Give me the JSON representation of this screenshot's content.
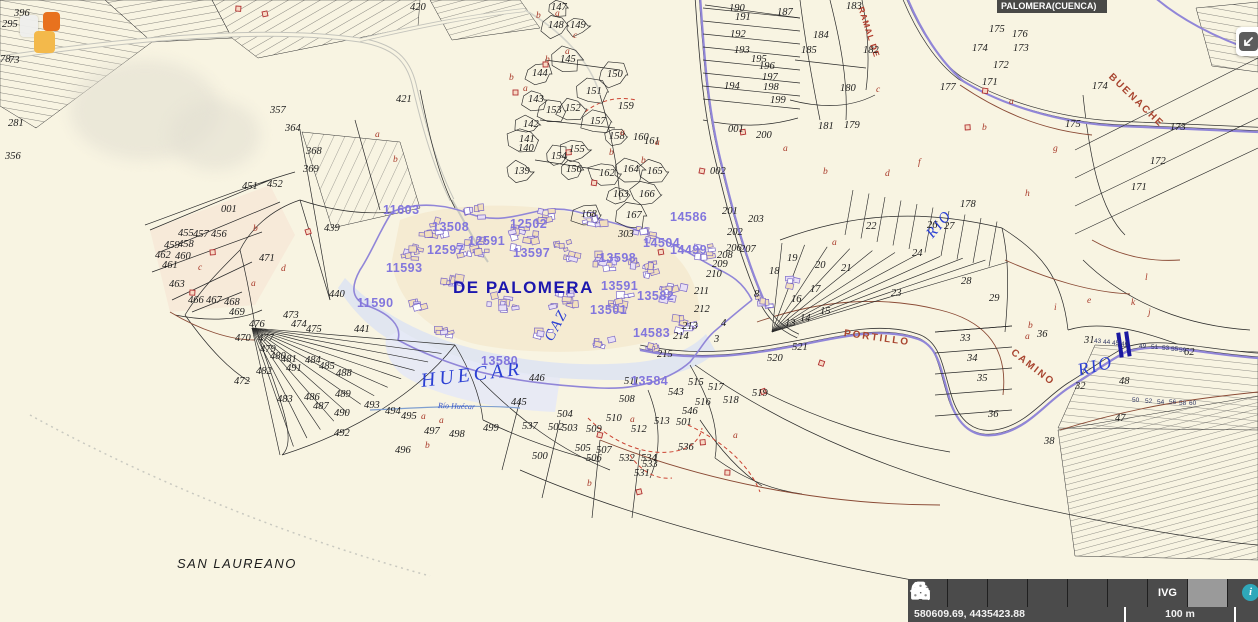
{
  "title_bar": {
    "text": "PALOMERA(CUENCA)"
  },
  "status_bar": {
    "coordinates": "580609.69, 4435423.88",
    "scale_label": "100 m"
  },
  "toolbar": {
    "buttons": [
      {
        "name": "expand-panel",
        "icon": "chevron-right-icon"
      },
      {
        "name": "zoom-search",
        "icon": "magnifier-icon"
      },
      {
        "name": "layers",
        "icon": "layers-icon"
      },
      {
        "name": "measure",
        "icon": "arrows-horizontal-icon"
      },
      {
        "name": "print",
        "icon": "printer-icon"
      },
      {
        "name": "point-query",
        "icon": "pointer-p-icon",
        "glyph": "P"
      },
      {
        "name": "ivg",
        "icon": "text",
        "label": "IVG"
      },
      {
        "name": "cartography",
        "icon": "dice-icon",
        "active": true
      },
      {
        "name": "help",
        "icon": "info-circle-icon",
        "glyph": "i",
        "partial": true
      }
    ]
  },
  "colors": {
    "background": "#f8f4e2",
    "boundary_purple": "#9186d8",
    "urban_number": "#8276dd",
    "water_label": "#2b3fd4",
    "road_label": "#a8442f",
    "town_label": "#1c17ae",
    "toolbar_bg": "#4b4b4b",
    "toolbar_active_bg": "#9a9a9a",
    "marker_orange": "#e8721e",
    "marker_yellow": "#f3b94b",
    "bridge_blue": "#1a18a0",
    "info_teal": "#2fa8ba"
  },
  "map": {
    "place_names": [
      {
        "t": "DE PALOMERA",
        "x": 453,
        "y": 278,
        "r": 0,
        "c": "town"
      },
      {
        "t": "SAN LAUREANO",
        "x": 177,
        "y": 556,
        "r": 0,
        "c": "village"
      },
      {
        "t": "HUECAR",
        "x": 421,
        "y": 370,
        "r": -7,
        "c": "water-xl"
      },
      {
        "t": "CAZ",
        "x": 549,
        "y": 332,
        "r": -62,
        "c": "water-lg"
      },
      {
        "t": "RIO",
        "x": 930,
        "y": 228,
        "r": -50,
        "c": "water-lg"
      },
      {
        "t": "RIO",
        "x": 1078,
        "y": 360,
        "r": -14,
        "c": "water-xl2"
      },
      {
        "t": "Río Huécar",
        "x": 438,
        "y": 401,
        "r": 2,
        "c": "water-xs"
      },
      {
        "t": "PORTILLO",
        "x": 844,
        "y": 328,
        "r": 8,
        "c": "road-lbl"
      },
      {
        "t": "CAMINO",
        "x": 1012,
        "y": 346,
        "r": 38,
        "c": "road-lbl"
      },
      {
        "t": "BUENACHE",
        "x": 1110,
        "y": 70,
        "r": 44,
        "c": "road-lbl"
      },
      {
        "t": "RAMAL DE",
        "x": 861,
        "y": 2,
        "r": 72,
        "c": "road-lbl-sm"
      }
    ],
    "parcel_numbers": [
      [
        "295",
        2,
        19
      ],
      [
        "396",
        14,
        8
      ],
      [
        "78",
        0,
        54
      ],
      [
        "73",
        9,
        55
      ],
      [
        "281",
        8,
        118
      ],
      [
        "356",
        5,
        151
      ],
      [
        "420",
        410,
        2
      ],
      [
        "421",
        396,
        94
      ],
      [
        "357",
        270,
        105
      ],
      [
        "364",
        285,
        123
      ],
      [
        "368",
        306,
        146
      ],
      [
        "369",
        303,
        164
      ],
      [
        "439",
        324,
        223
      ],
      [
        "440",
        329,
        289
      ],
      [
        "441",
        354,
        324
      ],
      [
        "446",
        529,
        373
      ],
      [
        "445",
        511,
        397
      ],
      [
        "001",
        221,
        204
      ],
      [
        "451",
        242,
        181
      ],
      [
        "452",
        267,
        179
      ],
      [
        "455",
        178,
        228
      ],
      [
        "457",
        193,
        229
      ],
      [
        "456",
        211,
        229
      ],
      [
        "458",
        178,
        239
      ],
      [
        "459",
        164,
        240
      ],
      [
        "462",
        155,
        250
      ],
      [
        "460",
        175,
        251
      ],
      [
        "461",
        162,
        260
      ],
      [
        "463",
        169,
        279
      ],
      [
        "466",
        188,
        295
      ],
      [
        "467",
        206,
        295
      ],
      [
        "468",
        224,
        297
      ],
      [
        "469",
        229,
        307
      ],
      [
        "471",
        259,
        253
      ],
      [
        "472",
        234,
        376
      ],
      [
        "476",
        249,
        319
      ],
      [
        "477",
        258,
        333
      ],
      [
        "470",
        235,
        333
      ],
      [
        "479",
        260,
        344
      ],
      [
        "480",
        270,
        351
      ],
      [
        "481",
        281,
        354
      ],
      [
        "473",
        283,
        310
      ],
      [
        "474",
        291,
        319
      ],
      [
        "475",
        306,
        324
      ],
      [
        "482",
        256,
        366
      ],
      [
        "483",
        277,
        394
      ],
      [
        "484",
        305,
        355
      ],
      [
        "485",
        319,
        361
      ],
      [
        "486",
        304,
        392
      ],
      [
        "487",
        313,
        401
      ],
      [
        "488",
        336,
        368
      ],
      [
        "489",
        335,
        389
      ],
      [
        "490",
        334,
        408
      ],
      [
        "491",
        286,
        363
      ],
      [
        "492",
        334,
        428
      ],
      [
        "493",
        364,
        400
      ],
      [
        "494",
        385,
        406
      ],
      [
        "495",
        401,
        411
      ],
      [
        "496",
        395,
        445
      ],
      [
        "497",
        424,
        426
      ],
      [
        "498",
        449,
        429
      ],
      [
        "499",
        483,
        423
      ],
      [
        "500",
        532,
        451
      ],
      [
        "504",
        557,
        409
      ],
      [
        "502",
        548,
        422
      ],
      [
        "503",
        562,
        423
      ],
      [
        "505",
        575,
        443
      ],
      [
        "506",
        586,
        453
      ],
      [
        "507",
        596,
        445
      ],
      [
        "509",
        586,
        424
      ],
      [
        "510",
        606,
        413
      ],
      [
        "508",
        619,
        394
      ],
      [
        "511",
        624,
        376
      ],
      [
        "512",
        631,
        424
      ],
      [
        "513",
        654,
        416
      ],
      [
        "501",
        676,
        417
      ],
      [
        "515",
        688,
        377
      ],
      [
        "516",
        695,
        397
      ],
      [
        "517",
        708,
        382
      ],
      [
        "518",
        723,
        395
      ],
      [
        "519",
        752,
        388
      ],
      [
        "543",
        668,
        387
      ],
      [
        "546",
        682,
        406
      ],
      [
        "536",
        678,
        442
      ],
      [
        "531",
        634,
        468
      ],
      [
        "532",
        619,
        453
      ],
      [
        "533",
        642,
        459
      ],
      [
        "534",
        641,
        453
      ],
      [
        "537",
        522,
        421
      ],
      [
        "520",
        767,
        353
      ],
      [
        "521",
        792,
        342
      ],
      [
        "211",
        694,
        286
      ],
      [
        "212",
        694,
        304
      ],
      [
        "213",
        682,
        321
      ],
      [
        "214",
        673,
        331
      ],
      [
        "215",
        657,
        349
      ],
      [
        "208",
        717,
        250
      ],
      [
        "209",
        712,
        259
      ],
      [
        "210",
        706,
        269
      ],
      [
        "206",
        726,
        243
      ],
      [
        "207",
        740,
        244
      ],
      [
        "201",
        722,
        206
      ],
      [
        "202",
        727,
        227
      ],
      [
        "203",
        748,
        214
      ],
      [
        "200",
        756,
        130
      ],
      [
        "199",
        770,
        95
      ],
      [
        "198",
        763,
        82
      ],
      [
        "197",
        762,
        72
      ],
      [
        "196",
        759,
        61
      ],
      [
        "195",
        751,
        54
      ],
      [
        "194",
        724,
        81
      ],
      [
        "193",
        734,
        45
      ],
      [
        "192",
        730,
        29
      ],
      [
        "191",
        735,
        12
      ],
      [
        "190",
        729,
        3
      ],
      [
        "187",
        777,
        7
      ],
      [
        "183",
        846,
        1
      ],
      [
        "184",
        813,
        30
      ],
      [
        "185",
        801,
        45
      ],
      [
        "182",
        863,
        45
      ],
      [
        "180",
        840,
        83
      ],
      [
        "181",
        818,
        121
      ],
      [
        "179",
        844,
        120
      ],
      [
        "177",
        940,
        82
      ],
      [
        "174",
        972,
        43
      ],
      [
        "175",
        989,
        24
      ],
      [
        "176",
        1012,
        29
      ],
      [
        "173",
        1013,
        43
      ],
      [
        "172",
        993,
        60
      ],
      [
        "171",
        982,
        77
      ],
      [
        "178",
        960,
        199
      ],
      [
        "174",
        1092,
        81
      ],
      [
        "175",
        1065,
        119
      ],
      [
        "173",
        1170,
        122
      ],
      [
        "172",
        1150,
        156
      ],
      [
        "171",
        1131,
        182
      ],
      [
        "139",
        514,
        166
      ],
      [
        "140",
        518,
        143
      ],
      [
        "141",
        519,
        134
      ],
      [
        "142",
        523,
        119
      ],
      [
        "143",
        528,
        94
      ],
      [
        "144",
        532,
        68
      ],
      [
        "145",
        560,
        54
      ],
      [
        "147",
        551,
        2
      ],
      [
        "148",
        548,
        20
      ],
      [
        "149",
        570,
        20
      ],
      [
        "150",
        607,
        69
      ],
      [
        "151",
        586,
        86
      ],
      [
        "152",
        565,
        103
      ],
      [
        "153",
        546,
        105
      ],
      [
        "154",
        551,
        151
      ],
      [
        "155",
        569,
        144
      ],
      [
        "156",
        566,
        164
      ],
      [
        "157",
        590,
        116
      ],
      [
        "158",
        609,
        131
      ],
      [
        "159",
        618,
        101
      ],
      [
        "160",
        633,
        132
      ],
      [
        "161",
        644,
        136
      ],
      [
        "162",
        599,
        168
      ],
      [
        "163",
        613,
        189
      ],
      [
        "164",
        623,
        164
      ],
      [
        "165",
        647,
        166
      ],
      [
        "166",
        639,
        189
      ],
      [
        "167",
        626,
        210
      ],
      [
        "168",
        581,
        209
      ],
      [
        "303",
        618,
        229
      ],
      [
        "22",
        866,
        221
      ],
      [
        "26",
        927,
        220
      ],
      [
        "27",
        944,
        221
      ],
      [
        "19",
        787,
        253
      ],
      [
        "18",
        769,
        266
      ],
      [
        "20",
        815,
        260
      ],
      [
        "21",
        841,
        263
      ],
      [
        "24",
        912,
        248
      ],
      [
        "23",
        891,
        288
      ],
      [
        "28",
        961,
        276
      ],
      [
        "29",
        989,
        293
      ],
      [
        "17",
        810,
        284
      ],
      [
        "16",
        791,
        294
      ],
      [
        "15",
        820,
        306
      ],
      [
        "14",
        800,
        313
      ],
      [
        "13",
        785,
        318
      ],
      [
        "8",
        754,
        289
      ],
      [
        "4",
        721,
        318
      ],
      [
        "3",
        714,
        334
      ],
      [
        "33",
        960,
        333
      ],
      [
        "34",
        967,
        353
      ],
      [
        "35",
        977,
        373
      ],
      [
        "36",
        988,
        409
      ],
      [
        "36",
        1037,
        329
      ],
      [
        "31",
        1084,
        335
      ],
      [
        "62",
        1184,
        347
      ],
      [
        "48",
        1119,
        376
      ],
      [
        "47",
        1115,
        413
      ],
      [
        "38",
        1044,
        436
      ],
      [
        "32",
        1075,
        381
      ],
      [
        "002",
        710,
        166
      ],
      [
        "001",
        728,
        124
      ]
    ],
    "urban_parcel_numbers": [
      [
        "11603",
        383,
        203
      ],
      [
        "13508",
        432,
        220
      ],
      [
        "12591",
        468,
        234
      ],
      [
        "12502",
        510,
        217
      ],
      [
        "12597",
        427,
        243
      ],
      [
        "13597",
        513,
        246
      ],
      [
        "11593",
        386,
        261
      ],
      [
        "11590",
        357,
        296
      ],
      [
        "13598",
        599,
        251
      ],
      [
        "13591",
        601,
        279
      ],
      [
        "13582",
        637,
        289
      ],
      [
        "13501",
        590,
        303
      ],
      [
        "14583",
        633,
        326
      ],
      [
        "13580",
        481,
        354
      ],
      [
        "13584",
        631,
        374
      ],
      [
        "14504",
        643,
        236
      ],
      [
        "14499",
        670,
        243
      ],
      [
        "14586",
        670,
        210
      ]
    ],
    "subparcel_letters": [
      [
        "b",
        393,
        155
      ],
      [
        "a",
        375,
        130
      ],
      [
        "c",
        198,
        263
      ],
      [
        "b",
        253,
        224
      ],
      [
        "a",
        251,
        279
      ],
      [
        "d",
        281,
        264
      ],
      [
        "a",
        421,
        412
      ],
      [
        "a",
        439,
        416
      ],
      [
        "b",
        425,
        441
      ],
      [
        "b",
        587,
        479
      ],
      [
        "a",
        630,
        415
      ],
      [
        "a",
        733,
        431
      ],
      [
        "a",
        783,
        144
      ],
      [
        "b",
        823,
        167
      ],
      [
        "d",
        885,
        169
      ],
      [
        "f",
        918,
        158
      ],
      [
        "c",
        876,
        85
      ],
      [
        "g",
        1053,
        144
      ],
      [
        "h",
        1025,
        189
      ],
      [
        "a",
        1009,
        97
      ],
      [
        "b",
        982,
        123
      ],
      [
        "e",
        1087,
        296
      ],
      [
        "k",
        1131,
        298
      ],
      [
        "l",
        1145,
        273
      ],
      [
        "i",
        1054,
        303
      ],
      [
        "j",
        1148,
        308
      ],
      [
        "a",
        832,
        238
      ],
      [
        "a",
        555,
        9
      ],
      [
        "b",
        536,
        11
      ],
      [
        "c",
        573,
        31
      ],
      [
        "a",
        565,
        47
      ],
      [
        "b",
        545,
        55
      ],
      [
        "a",
        523,
        84
      ],
      [
        "b",
        509,
        73
      ],
      [
        "a",
        620,
        128
      ],
      [
        "b",
        609,
        148
      ],
      [
        "a",
        655,
        138
      ],
      [
        "b",
        641,
        156
      ],
      [
        "a",
        1025,
        332
      ],
      [
        "b",
        1028,
        321
      ]
    ],
    "strip_numbers": [
      [
        "43",
        1094,
        338
      ],
      [
        "44",
        1103,
        339
      ],
      [
        "45",
        1112,
        340
      ],
      [
        "46",
        1121,
        341
      ],
      [
        "49",
        1139,
        343
      ],
      [
        "51",
        1151,
        344
      ],
      [
        "53",
        1162,
        345
      ],
      [
        "55",
        1171,
        346
      ],
      [
        "59",
        1179,
        347
      ],
      [
        "50",
        1132,
        397
      ],
      [
        "52",
        1145,
        398
      ],
      [
        "54",
        1157,
        399
      ],
      [
        "56",
        1169,
        399
      ],
      [
        "58",
        1179,
        400
      ],
      [
        "60",
        1189,
        400
      ]
    ]
  }
}
